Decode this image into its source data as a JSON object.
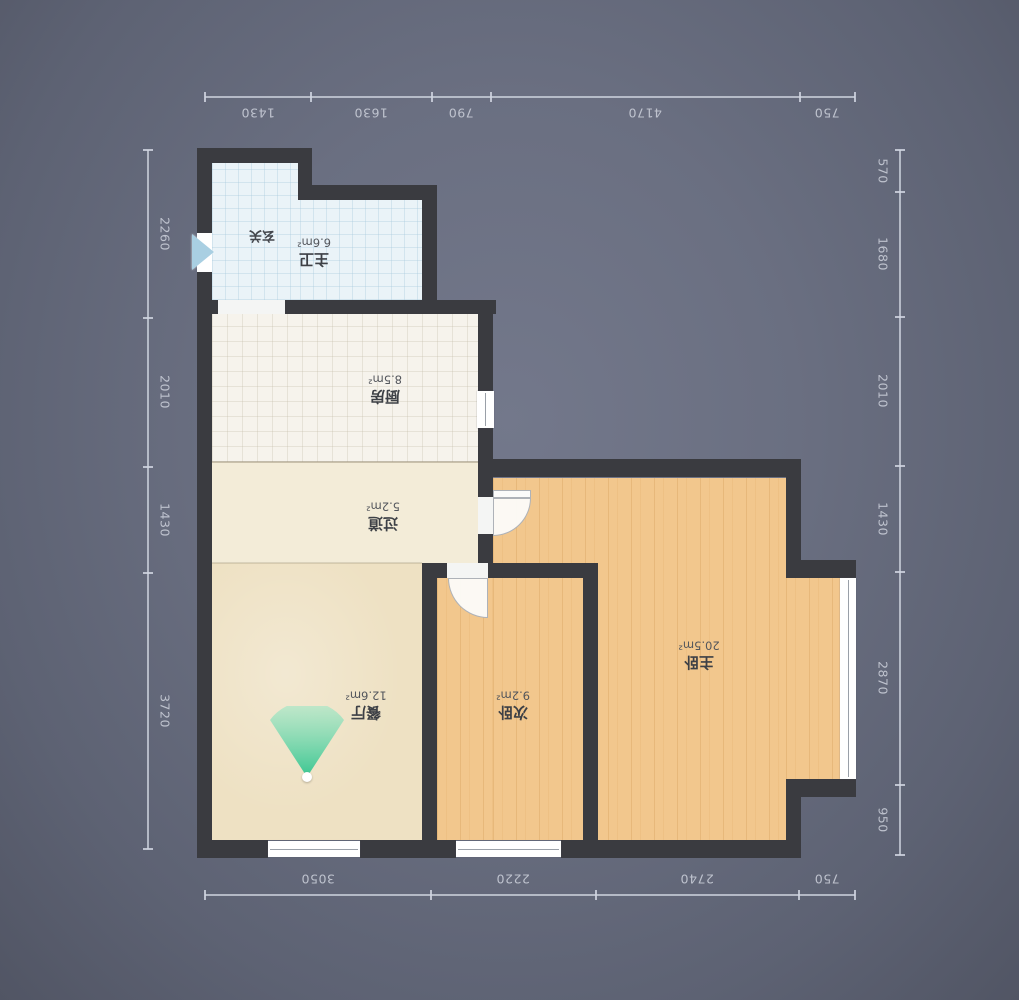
{
  "plan_title": "apartment-floorplan",
  "rooms": {
    "foyer": {
      "name": "玄关",
      "area": ""
    },
    "master_bath": {
      "name": "主卫",
      "area": "6.6m²"
    },
    "kitchen": {
      "name": "厨房",
      "area": "8.5m²"
    },
    "hallway": {
      "name": "过道",
      "area": "5.2m²"
    },
    "dining": {
      "name": "餐厅",
      "area": "12.6m²"
    },
    "second_bedroom": {
      "name": "次卧",
      "area": "9.2m²"
    },
    "master_bedroom": {
      "name": "主卧",
      "area": "20.5m²"
    }
  },
  "dims": {
    "top": [
      "1430",
      "1630",
      "790",
      "4170",
      "750"
    ],
    "bottom": [
      "3050",
      "2220",
      "2740",
      "750"
    ],
    "left": [
      "2260",
      "2010",
      "1430",
      "3720"
    ],
    "right": [
      "570",
      "1680",
      "2010",
      "1430",
      "2870",
      "950"
    ]
  },
  "colors": {
    "background": "#666b7d",
    "wall": "#3a3b40",
    "bath_floor": "#eaf3f8",
    "kitchen_floor": "#f6f3ec",
    "hall_floor": "#f3ecd8",
    "dining_floor": "#eee1c3",
    "wood_floor": "#f2c78d",
    "view_cone": "#3fca95",
    "entrance_arrow": "#a9cfe2",
    "dim_text": "#d2d6e0"
  }
}
